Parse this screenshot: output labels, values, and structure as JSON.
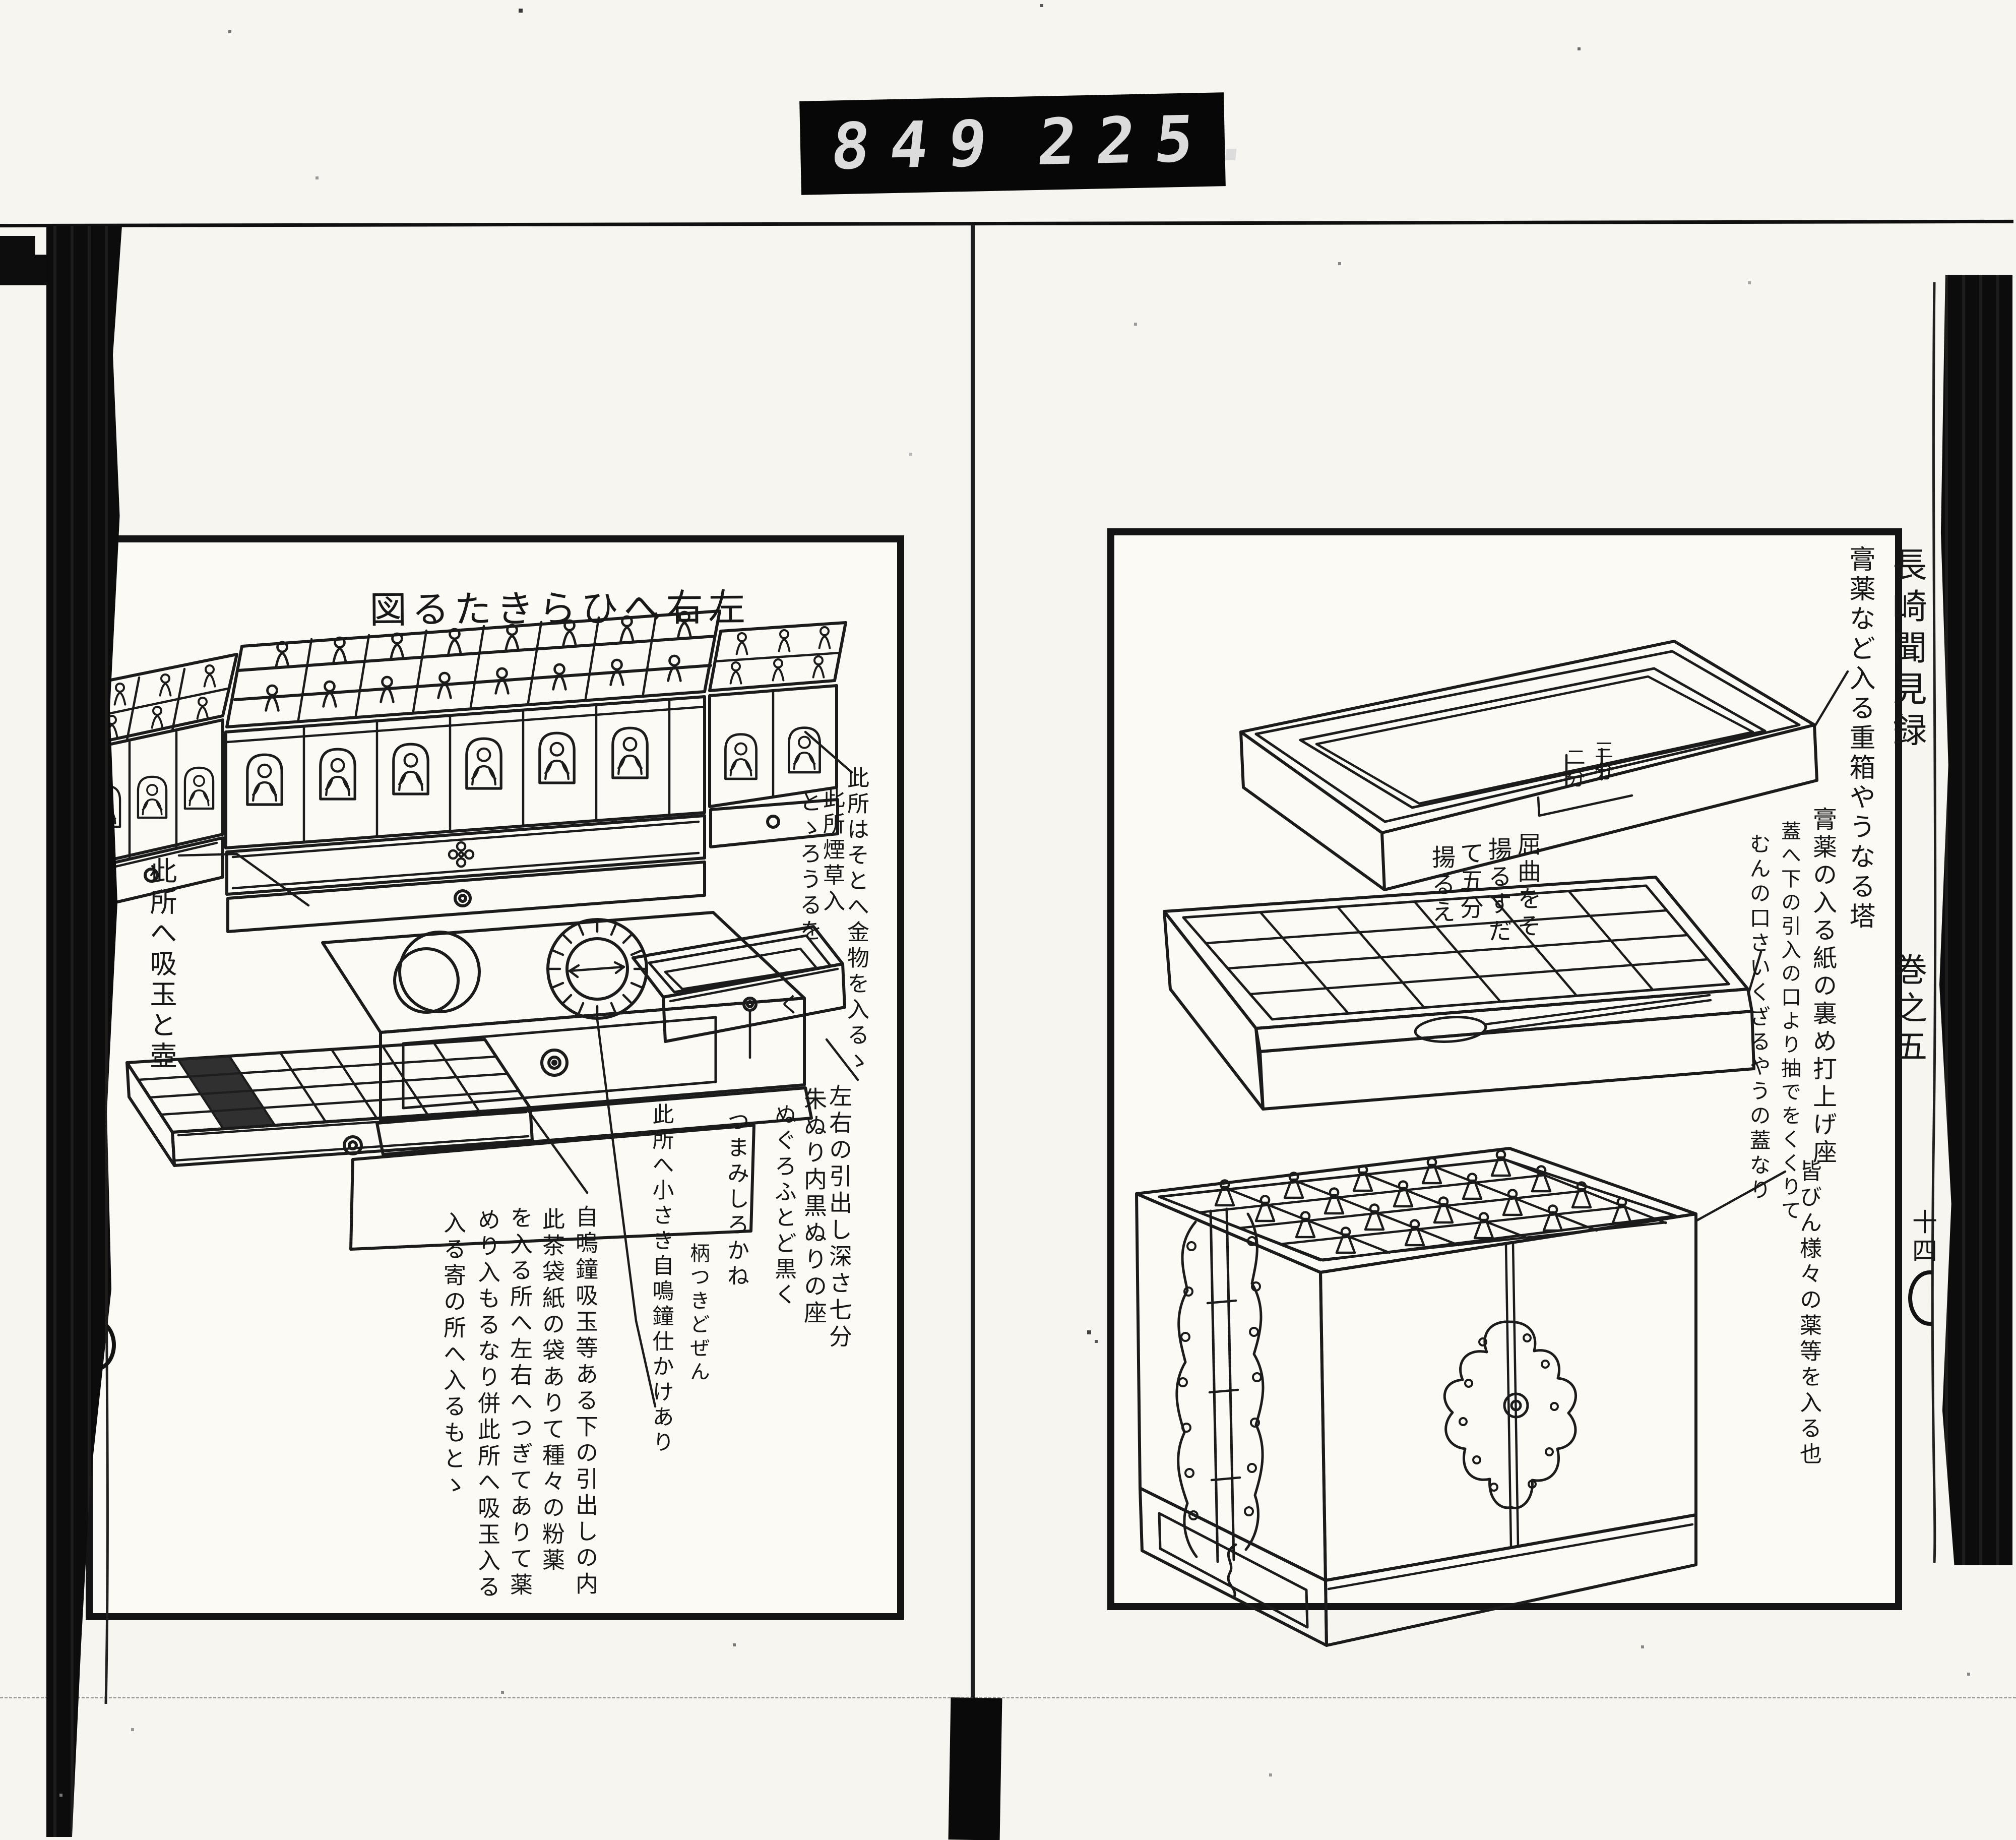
{
  "scan": {
    "counter_left": "849",
    "counter_right": "225.",
    "ink_color": "#1b1b1b",
    "paper_color": "#f6f5f0"
  },
  "left_page": {
    "header": {
      "text": "左右へひらきたる図",
      "display": "図るたきらひへ右左"
    },
    "annotations": {
      "right_top": [
        "此所はそとへ金物を入るゝ",
        "此所煙草入",
        "とゝろうるを",
        "く"
      ],
      "left_side": "此所へ吸玉と壺",
      "drawers": [
        "左右の引出し深さ七分",
        "朱ぬり内黒ぬりの座"
      ],
      "middle": [
        "ぬぐろふとど黒く",
        "つまみしろかね",
        "柄つきどぜん",
        "此所へ小さき自鳴鐘仕かけあり"
      ],
      "bottom": [
        "自鳴鐘吸玉等ある下の引出しの内",
        "此茶袋紙の袋ありて種々の粉薬",
        "を入る所へ左右へつぎてありて薬",
        "めり入もるなり併此所へ吸玉入る",
        "入る寄の所へ入るもとゝ"
      ]
    },
    "page_number": "十五"
  },
  "right_page": {
    "caption_right": "膏薬など入る重箱やうなる塔",
    "lid_labels": [
      "三分",
      "二分"
    ],
    "lid_note": [
      "屈曲をそ",
      "揚るすだ",
      "て五分",
      "揚るえ"
    ],
    "caption_mid": [
      "膏薬の入る紙の裏め打上げ座",
      "蓋へ下の引入の口より抽でをくくりて",
      "むんの口さいくざるやうの蓋なり"
    ],
    "caption_bottom": "皆びん様々の薬等を入る也",
    "page_number": "十四"
  },
  "margins": {
    "left_smudge": "長崎聞見録巻之五",
    "right_title": "長崎聞見録",
    "right_volume": "巻之五"
  }
}
